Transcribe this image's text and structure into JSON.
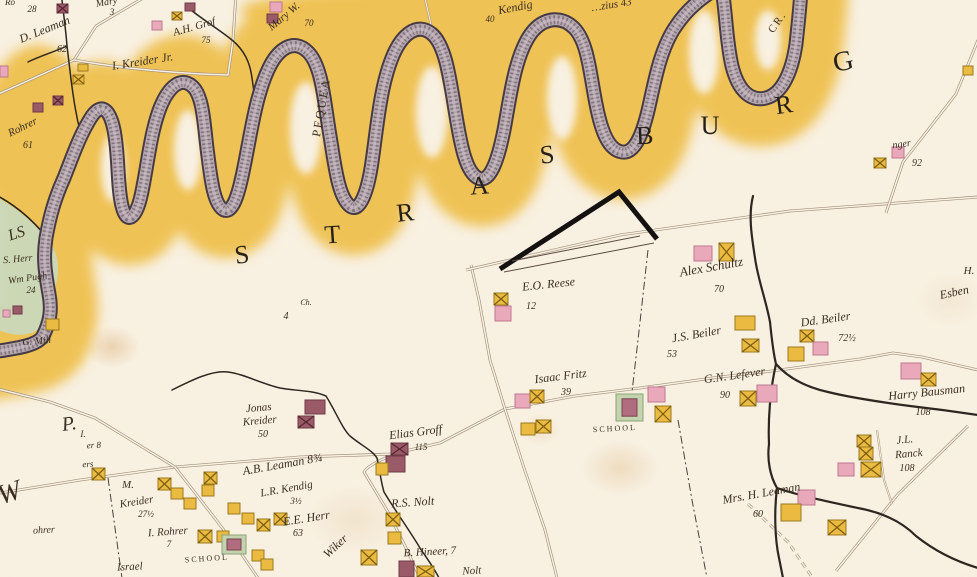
{
  "map": {
    "township_letters": [
      {
        "ch": "S",
        "x": 243,
        "y": 263,
        "s": 26,
        "r": -8
      },
      {
        "ch": "T",
        "x": 333,
        "y": 243,
        "s": 26,
        "r": -4
      },
      {
        "ch": "R",
        "x": 406,
        "y": 221,
        "s": 26,
        "r": -6
      },
      {
        "ch": "A",
        "x": 480,
        "y": 194,
        "s": 26,
        "r": -4
      },
      {
        "ch": "S",
        "x": 548,
        "y": 163,
        "s": 26,
        "r": -6
      },
      {
        "ch": "B",
        "x": 645,
        "y": 144,
        "s": 26,
        "r": -2
      },
      {
        "ch": "U",
        "x": 710,
        "y": 134,
        "s": 26,
        "r": 0
      },
      {
        "ch": "R",
        "x": 785,
        "y": 113,
        "s": 26,
        "r": -8
      },
      {
        "ch": "G",
        "x": 845,
        "y": 70,
        "s": 28,
        "r": -12
      }
    ],
    "labels": [
      {
        "t": "Ro",
        "x": 10,
        "y": 5,
        "r": 0,
        "s": 9
      },
      {
        "t": "28",
        "x": 32,
        "y": 12,
        "r": 0,
        "s": 9
      },
      {
        "t": "Mary",
        "x": 107,
        "y": 5,
        "r": -10,
        "s": 10
      },
      {
        "t": "3",
        "x": 112,
        "y": 15,
        "r": 0,
        "s": 9
      },
      {
        "t": "D. Leaman",
        "x": 46,
        "y": 33,
        "r": -22,
        "s": 12
      },
      {
        "t": "62",
        "x": 62,
        "y": 52,
        "r": 0,
        "s": 10
      },
      {
        "t": "A.H. Grof",
        "x": 195,
        "y": 30,
        "r": -16,
        "s": 11
      },
      {
        "t": "75",
        "x": 206,
        "y": 43,
        "r": 0,
        "s": 9
      },
      {
        "t": "Mary W.",
        "x": 286,
        "y": 19,
        "r": -40,
        "s": 11
      },
      {
        "t": "70",
        "x": 309,
        "y": 26,
        "r": 0,
        "s": 9
      },
      {
        "t": "I. Kreider Jr.",
        "x": 143,
        "y": 65,
        "r": -9,
        "s": 12
      },
      {
        "t": "Rohrer",
        "x": 24,
        "y": 130,
        "r": -26,
        "s": 11
      },
      {
        "t": "61",
        "x": 28,
        "y": 148,
        "r": 0,
        "s": 10
      },
      {
        "t": "Kendig",
        "x": 516,
        "y": 11,
        "r": -11,
        "s": 12
      },
      {
        "t": "40",
        "x": 490,
        "y": 22,
        "r": 0,
        "s": 9
      },
      {
        "t": "…zius 43",
        "x": 612,
        "y": 8,
        "r": -9,
        "s": 11
      },
      {
        "t": "PEQUEA",
        "x": 325,
        "y": 108,
        "r": -80,
        "s": 12,
        "k": "sc"
      },
      {
        "t": "CR.",
        "x": 780,
        "y": 24,
        "r": -55,
        "s": 11,
        "k": "sc"
      },
      {
        "t": "nger",
        "x": 902,
        "y": 147,
        "r": -8,
        "s": 10
      },
      {
        "t": "92",
        "x": 917,
        "y": 166,
        "r": 0,
        "s": 10
      },
      {
        "t": "H.",
        "x": 969,
        "y": 274,
        "r": 0,
        "s": 11
      },
      {
        "t": "Esben",
        "x": 955,
        "y": 296,
        "r": -12,
        "s": 12
      },
      {
        "t": "E.O. Reese",
        "x": 549,
        "y": 288,
        "r": -6,
        "s": 12
      },
      {
        "t": "12",
        "x": 531,
        "y": 309,
        "r": 0,
        "s": 10
      },
      {
        "t": "Alex Schultz",
        "x": 712,
        "y": 271,
        "r": -10,
        "s": 13
      },
      {
        "t": "70",
        "x": 719,
        "y": 292,
        "r": 0,
        "s": 10
      },
      {
        "t": "J.S. Beiler",
        "x": 697,
        "y": 338,
        "r": -10,
        "s": 12
      },
      {
        "t": "53",
        "x": 672,
        "y": 357,
        "r": 0,
        "s": 10
      },
      {
        "t": "Dd. Beiler",
        "x": 826,
        "y": 323,
        "r": -8,
        "s": 12
      },
      {
        "t": "72½",
        "x": 847,
        "y": 341,
        "r": 0,
        "s": 10
      },
      {
        "t": "G.N. Lefever",
        "x": 735,
        "y": 379,
        "r": -8,
        "s": 12
      },
      {
        "t": "90",
        "x": 725,
        "y": 398,
        "r": 0,
        "s": 10
      },
      {
        "t": "Harry Bausman",
        "x": 927,
        "y": 396,
        "r": -6,
        "s": 12
      },
      {
        "t": "108",
        "x": 923,
        "y": 415,
        "r": 0,
        "s": 10
      },
      {
        "t": "J.L.",
        "x": 905,
        "y": 443,
        "r": -5,
        "s": 11
      },
      {
        "t": "Ranck",
        "x": 909,
        "y": 457,
        "r": -5,
        "s": 11
      },
      {
        "t": "108",
        "x": 907,
        "y": 471,
        "r": 0,
        "s": 10
      },
      {
        "t": "Mrs. H. Leaman",
        "x": 762,
        "y": 497,
        "r": -10,
        "s": 12
      },
      {
        "t": "60",
        "x": 758,
        "y": 517,
        "r": 0,
        "s": 10
      },
      {
        "t": "Isaac Fritz",
        "x": 561,
        "y": 380,
        "r": -7,
        "s": 12
      },
      {
        "t": "39",
        "x": 566,
        "y": 395,
        "r": 0,
        "s": 10
      },
      {
        "t": "SCHOOL",
        "x": 615,
        "y": 431,
        "r": -3,
        "s": 8,
        "k": "sc"
      },
      {
        "t": "Elias Groff",
        "x": 416,
        "y": 436,
        "r": -7,
        "s": 12
      },
      {
        "t": "115",
        "x": 421,
        "y": 450,
        "r": 0,
        "s": 9
      },
      {
        "t": "Jonas",
        "x": 259,
        "y": 411,
        "r": -5,
        "s": 11
      },
      {
        "t": "Kreider",
        "x": 260,
        "y": 424,
        "r": -5,
        "s": 11
      },
      {
        "t": "50",
        "x": 263,
        "y": 437,
        "r": 0,
        "s": 10
      },
      {
        "t": "A.B. Leaman 8¾",
        "x": 283,
        "y": 468,
        "r": -10,
        "s": 12
      },
      {
        "t": "L.R. Kendig",
        "x": 287,
        "y": 492,
        "r": -10,
        "s": 11
      },
      {
        "t": "3½",
        "x": 296,
        "y": 504,
        "r": 0,
        "s": 9
      },
      {
        "t": "M.",
        "x": 128,
        "y": 488,
        "r": 0,
        "s": 11
      },
      {
        "t": "Kreider",
        "x": 137,
        "y": 505,
        "r": -9,
        "s": 11
      },
      {
        "t": "27½",
        "x": 146,
        "y": 517,
        "r": 0,
        "s": 9
      },
      {
        "t": "E.E. Herr",
        "x": 307,
        "y": 522,
        "r": -9,
        "s": 12
      },
      {
        "t": "63",
        "x": 298,
        "y": 536,
        "r": 0,
        "s": 10
      },
      {
        "t": "I. Rohrer",
        "x": 168,
        "y": 535,
        "r": -4,
        "s": 11
      },
      {
        "t": "7",
        "x": 169,
        "y": 547,
        "r": 0,
        "s": 9
      },
      {
        "t": "SCHOOL",
        "x": 207,
        "y": 561,
        "r": -4,
        "s": 8,
        "k": "sc"
      },
      {
        "t": "Israel",
        "x": 130,
        "y": 570,
        "r": -3,
        "s": 11
      },
      {
        "t": "Wiker",
        "x": 338,
        "y": 549,
        "r": -43,
        "s": 12
      },
      {
        "t": "R.S. Nolt",
        "x": 413,
        "y": 506,
        "r": -4,
        "s": 12
      },
      {
        "t": "B. Hineer, 7",
        "x": 430,
        "y": 555,
        "r": -3,
        "s": 11
      },
      {
        "t": "Nolt",
        "x": 472,
        "y": 574,
        "r": -3,
        "s": 11
      },
      {
        "t": "ohrer",
        "x": 44,
        "y": 533,
        "r": -3,
        "s": 10
      },
      {
        "t": "I.",
        "x": 83,
        "y": 437,
        "r": 0,
        "s": 9
      },
      {
        "t": "er 8",
        "x": 94,
        "y": 448,
        "r": -3,
        "s": 9
      },
      {
        "t": "ers",
        "x": 88,
        "y": 467,
        "r": -3,
        "s": 9
      },
      {
        "t": "LS",
        "x": 18,
        "y": 238,
        "r": -18,
        "s": 16
      },
      {
        "t": "S. Herr",
        "x": 18,
        "y": 262,
        "r": -5,
        "s": 10
      },
      {
        "t": "Wm Pugh",
        "x": 28,
        "y": 281,
        "r": -8,
        "s": 10
      },
      {
        "t": "24",
        "x": 31,
        "y": 293,
        "r": 0,
        "s": 9
      },
      {
        "t": "G. Mill",
        "x": 37,
        "y": 344,
        "r": -5,
        "s": 10
      },
      {
        "t": "Ch.",
        "x": 306,
        "y": 305,
        "r": 0,
        "s": 8
      },
      {
        "t": "4",
        "x": 286,
        "y": 319,
        "r": 0,
        "s": 10
      },
      {
        "t": "W",
        "x": 12,
        "y": 501,
        "r": -18,
        "s": 28,
        "k": "big2"
      },
      {
        "t": "P.",
        "x": 70,
        "y": 430,
        "r": -8,
        "s": 20,
        "k": "big2"
      }
    ],
    "buildings": [
      [
        57,
        4,
        11,
        9,
        "mx"
      ],
      [
        152,
        21,
        10,
        9,
        "p"
      ],
      [
        172,
        12,
        10,
        8,
        "yx"
      ],
      [
        185,
        3,
        10,
        8,
        "m"
      ],
      [
        270,
        2,
        12,
        10,
        "p"
      ],
      [
        267,
        14,
        11,
        9,
        "m"
      ],
      [
        0,
        66,
        8,
        11,
        "p"
      ],
      [
        53,
        96,
        10,
        9,
        "mx"
      ],
      [
        33,
        103,
        10,
        9,
        "m"
      ],
      [
        78,
        64,
        10,
        7,
        "y"
      ],
      [
        73,
        75,
        11,
        9,
        "yx"
      ],
      [
        13,
        306,
        9,
        8,
        "m"
      ],
      [
        3,
        310,
        7,
        7,
        "p"
      ],
      [
        46,
        319,
        13,
        11,
        "y"
      ],
      [
        892,
        147,
        12,
        11,
        "p"
      ],
      [
        874,
        158,
        12,
        10,
        "yx"
      ],
      [
        494,
        293,
        14,
        12,
        "yx"
      ],
      [
        495,
        306,
        16,
        15,
        "p"
      ],
      [
        694,
        246,
        18,
        15,
        "p"
      ],
      [
        719,
        243,
        15,
        18,
        "yx"
      ],
      [
        735,
        316,
        20,
        14,
        "y"
      ],
      [
        742,
        339,
        17,
        13,
        "yx"
      ],
      [
        800,
        330,
        14,
        12,
        "yx"
      ],
      [
        788,
        347,
        16,
        14,
        "y"
      ],
      [
        813,
        342,
        15,
        13,
        "p"
      ],
      [
        740,
        391,
        16,
        15,
        "yx"
      ],
      [
        757,
        385,
        20,
        17,
        "p"
      ],
      [
        901,
        363,
        20,
        16,
        "p"
      ],
      [
        921,
        373,
        15,
        13,
        "yx"
      ],
      [
        648,
        387,
        17,
        15,
        "p"
      ],
      [
        655,
        406,
        16,
        16,
        "yx"
      ],
      [
        616,
        394,
        27,
        27,
        "s"
      ],
      [
        515,
        394,
        15,
        14,
        "p"
      ],
      [
        530,
        390,
        14,
        13,
        "yx"
      ],
      [
        521,
        423,
        14,
        12,
        "y"
      ],
      [
        536,
        420,
        15,
        13,
        "yx"
      ],
      [
        305,
        400,
        20,
        14,
        "m"
      ],
      [
        298,
        416,
        16,
        12,
        "mx"
      ],
      [
        391,
        443,
        17,
        12,
        "mx"
      ],
      [
        386,
        456,
        19,
        16,
        "m"
      ],
      [
        376,
        463,
        12,
        12,
        "y"
      ],
      [
        857,
        435,
        14,
        12,
        "yx"
      ],
      [
        859,
        447,
        14,
        13,
        "yx"
      ],
      [
        838,
        463,
        16,
        13,
        "p"
      ],
      [
        861,
        462,
        20,
        15,
        "yx"
      ],
      [
        798,
        490,
        17,
        15,
        "p"
      ],
      [
        781,
        504,
        20,
        17,
        "y"
      ],
      [
        828,
        520,
        18,
        15,
        "yx"
      ],
      [
        92,
        468,
        13,
        12,
        "yx"
      ],
      [
        158,
        478,
        13,
        12,
        "yx"
      ],
      [
        171,
        488,
        12,
        11,
        "y"
      ],
      [
        184,
        498,
        12,
        11,
        "y"
      ],
      [
        204,
        472,
        13,
        12,
        "yx"
      ],
      [
        202,
        485,
        12,
        11,
        "y"
      ],
      [
        228,
        503,
        12,
        11,
        "y"
      ],
      [
        242,
        513,
        12,
        11,
        "y"
      ],
      [
        257,
        519,
        13,
        12,
        "yx"
      ],
      [
        274,
        513,
        13,
        12,
        "yx"
      ],
      [
        198,
        530,
        14,
        13,
        "yx"
      ],
      [
        217,
        531,
        12,
        11,
        "y"
      ],
      [
        222,
        535,
        24,
        19,
        "s"
      ],
      [
        252,
        550,
        12,
        11,
        "y"
      ],
      [
        261,
        559,
        12,
        11,
        "y"
      ],
      [
        386,
        513,
        14,
        13,
        "yx"
      ],
      [
        388,
        532,
        13,
        12,
        "y"
      ],
      [
        361,
        550,
        16,
        15,
        "yx"
      ],
      [
        399,
        561,
        15,
        16,
        "m"
      ],
      [
        417,
        566,
        17,
        11,
        "yx"
      ],
      [
        963,
        66,
        10,
        9,
        "y"
      ]
    ],
    "colors": {
      "paper": "#f8f0e1",
      "floodplain": "#efc254",
      "creek_fill": "#b5a7ae",
      "creek_edge": "#463b45",
      "green_area": "#c9d8ba",
      "road": "#a08f7b",
      "stream_ink": "#2e2721",
      "label_ink": "#3a2e22",
      "house_pink": "#eaa9ba",
      "house_maroon": "#9a5a67",
      "barn_yellow": "#eaba41"
    }
  }
}
